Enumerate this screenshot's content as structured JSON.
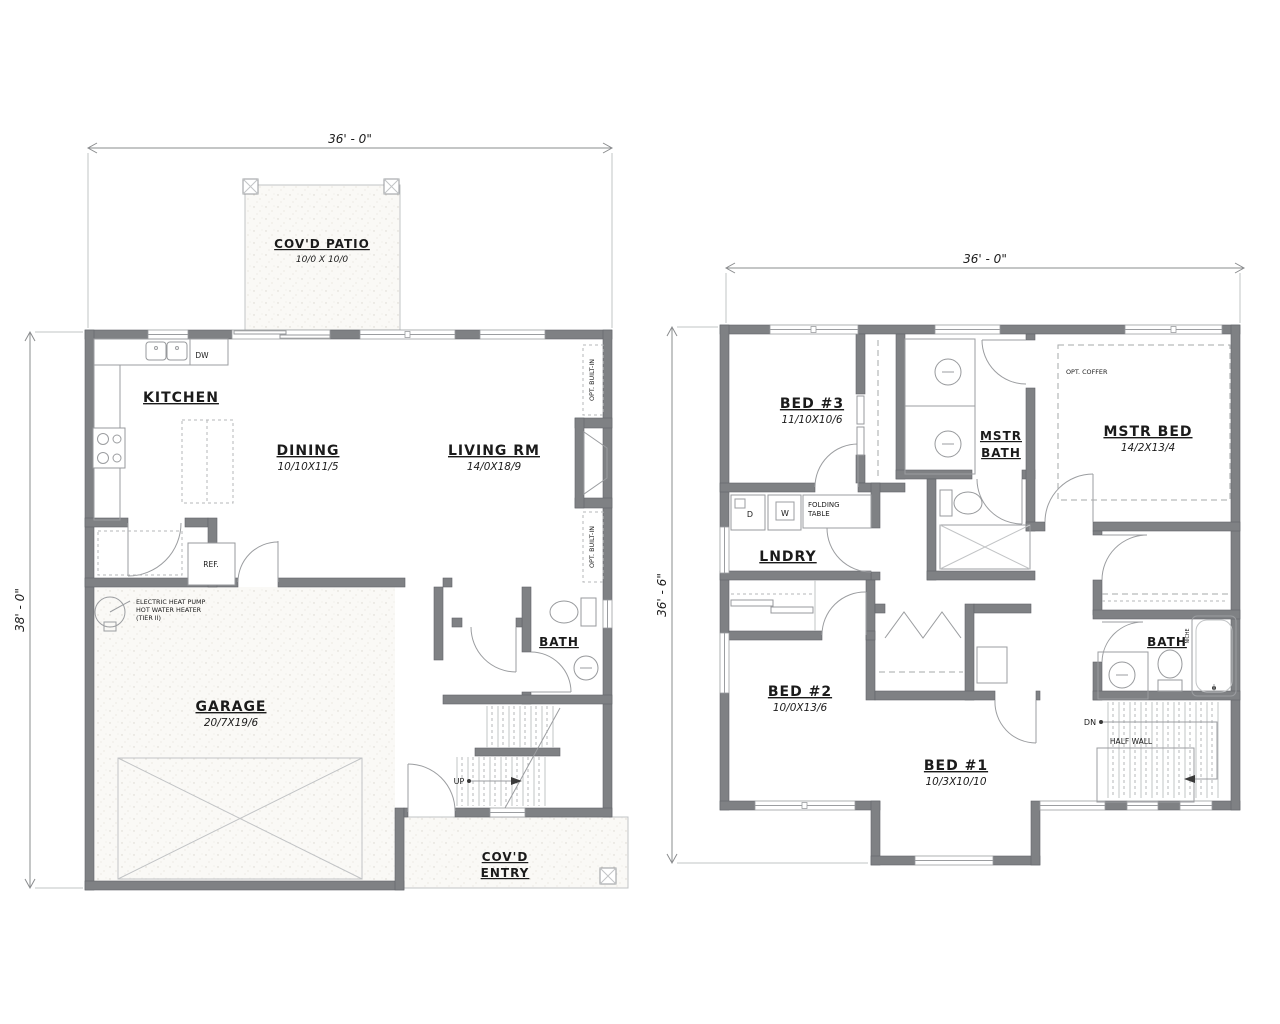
{
  "drawing_type": "two-story house floor plan",
  "first_floor": {
    "dim_width": "36' - 0\"",
    "dim_height": "38' - 0\"",
    "rooms": {
      "patio": {
        "label": "COV'D PATIO",
        "size": "10/0 X 10/0"
      },
      "kitchen": {
        "label": "KITCHEN"
      },
      "dining": {
        "label": "DINING",
        "size": "10/10X11/5"
      },
      "living": {
        "label": "LIVING RM",
        "size": "14/0X18/9"
      },
      "garage": {
        "label": "GARAGE",
        "size": "20/7X19/6"
      },
      "bath": {
        "label": "BATH"
      },
      "entry": {
        "label_line1": "COV'D",
        "label_line2": "ENTRY"
      }
    },
    "annotations": {
      "dw": "DW",
      "ref": "REF.",
      "up": "UP",
      "opt_builtin_upper": "OPT. BUILT-IN",
      "opt_builtin_lower": "OPT. BUILT-IN",
      "water_heater_line1": "ELECTRIC HEAT PUMP",
      "water_heater_line2": "HOT WATER HEATER",
      "water_heater_line3": "(TIER II)"
    }
  },
  "second_floor": {
    "dim_width": "36' - 0\"",
    "dim_height": "36' - 6\"",
    "rooms": {
      "bed3": {
        "label": "BED #3",
        "size": "11/10X10/6"
      },
      "mstr_bath": {
        "label_line1": "MSTR",
        "label_line2": "BATH"
      },
      "mstr_bed": {
        "label": "MSTR BED",
        "size": "14/2X13/4"
      },
      "lndry": {
        "label": "LNDRY"
      },
      "bed2": {
        "label": "BED #2",
        "size": "10/0X13/6"
      },
      "bed1": {
        "label": "BED #1",
        "size": "10/3X10/10"
      },
      "bath": {
        "label": "BATH"
      }
    },
    "annotations": {
      "opt_coffer": "OPT. COFFER",
      "dryer": "D",
      "washer": "W",
      "folding_table_line1": "FOLDING",
      "folding_table_line2": "TABLE",
      "dn": "DN",
      "half_wall": "HALF WALL",
      "niche": "NICHE"
    }
  },
  "colors": {
    "wall": "#7f8184",
    "thin_line": "#9b9da0",
    "text": "#1b1b1b",
    "stipple_bg": "#faf9f6"
  }
}
